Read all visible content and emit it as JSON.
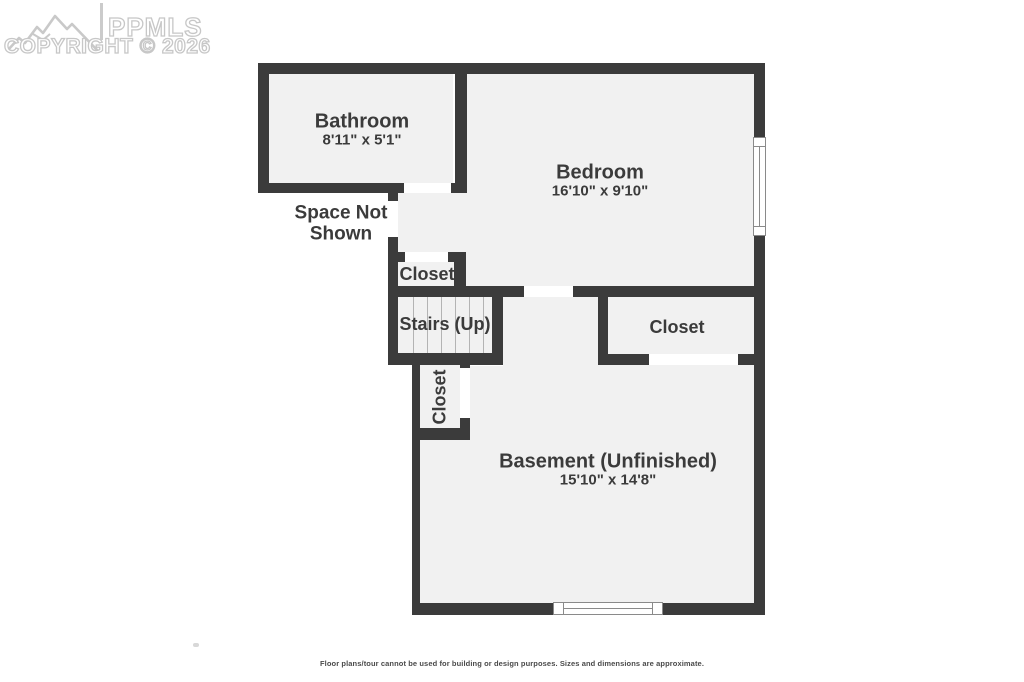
{
  "watermark": {
    "brand": "PPMLS",
    "copyright_line": "COPYRIGHT © 2026",
    "logo_icon": "mountain-range-icon",
    "color": "#c7c7c7"
  },
  "floor_plan": {
    "rooms": {
      "bathroom": {
        "name": "Bathroom",
        "dimensions": "8'11\" x 5'1\""
      },
      "bedroom": {
        "name": "Bedroom",
        "dimensions": "16'10\" x 9'10\""
      },
      "basement": {
        "name": "Basement (Unfinished)",
        "dimensions": "15'10\" x 14'8\""
      },
      "closet_upper": {
        "name": "Closet"
      },
      "closet_lower": {
        "name": "Closet"
      },
      "closet_right": {
        "name": "Closet"
      },
      "stairs": {
        "name": "Stairs (Up)"
      },
      "space_not_shown": {
        "line1": "Space Not",
        "line2": "Shown"
      }
    },
    "colors": {
      "wall": "#3b3b3b",
      "room_fill": "#f1f1f1",
      "label_text": "#3b3b3b",
      "door_opening": "#ffffff"
    }
  },
  "footer": {
    "disclaimer": "Floor plans/tour cannot be used for building or design purposes. Sizes and dimensions are approximate."
  }
}
